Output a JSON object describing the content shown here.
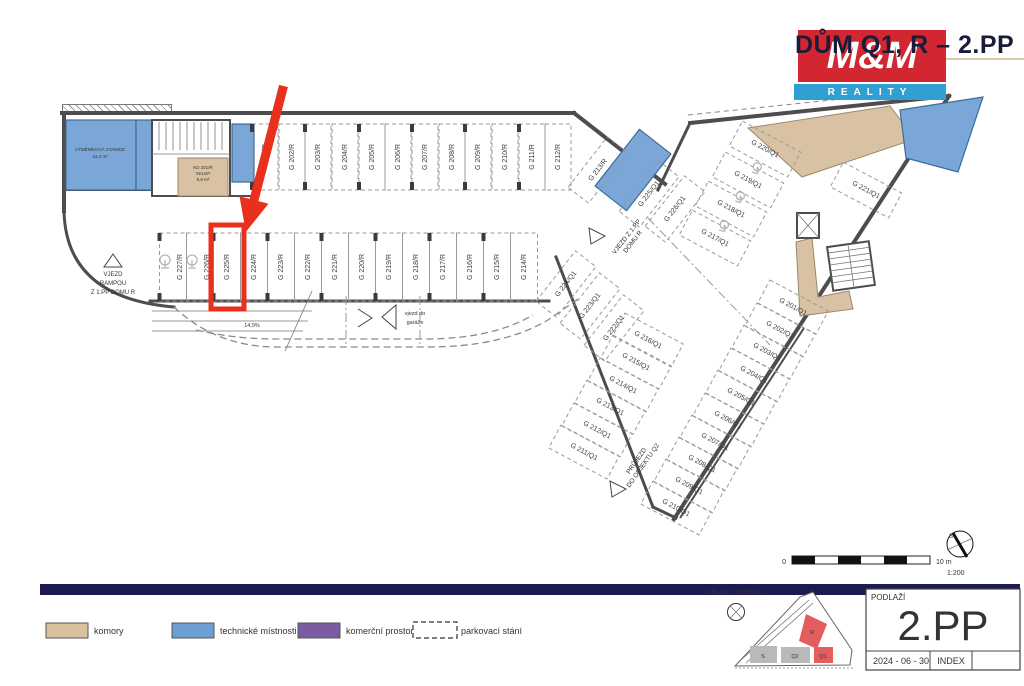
{
  "header": {
    "title": "DŮM Q1, R – 2.PP",
    "logo": {
      "top": "M&M",
      "bottom": "REALITY",
      "red": "#d22630",
      "blue": "#2f9fd4"
    }
  },
  "plan": {
    "texts": {
      "vjezd_rampou": [
        "VJEZD",
        "RAMPOU",
        "Z 1.PP DOMU R"
      ],
      "ramp_slope": "14,9%",
      "vjezd_garaz": [
        "vjezd do",
        "garáže"
      ],
      "vjezd_1pp": [
        "VJEZD Z 1.PP",
        "DOMU R"
      ],
      "prujezd": [
        "PRŮJEZD",
        "DO OBJEKTU Q2"
      ]
    },
    "rooms": {
      "vymenikova": [
        "VÝMĚNÍKOVÁ STANICE",
        "34,4 m²"
      ],
      "sklep": [
        "KD 201/R",
        "SKLEP",
        "5,9 m²"
      ]
    },
    "highlight": {
      "label": "G 225/R",
      "x": 211,
      "y": 225,
      "w": 33,
      "h": 84,
      "color": "#e8301c"
    },
    "stalls": [
      {
        "label": "G 201/R",
        "x": 265,
        "y": 157,
        "w": 26,
        "h": 66,
        "rot": 0,
        "lrot": -90
      },
      {
        "label": "G 202/R",
        "x": 292,
        "y": 157,
        "w": 26,
        "h": 66,
        "rot": 0,
        "lrot": -90
      },
      {
        "label": "G 203/R",
        "x": 318,
        "y": 157,
        "w": 26,
        "h": 66,
        "rot": 0,
        "lrot": -90
      },
      {
        "label": "G 204/R",
        "x": 345,
        "y": 157,
        "w": 26,
        "h": 66,
        "rot": 0,
        "lrot": -90
      },
      {
        "label": "G 205/R",
        "x": 372,
        "y": 157,
        "w": 26,
        "h": 66,
        "rot": 0,
        "lrot": -90
      },
      {
        "label": "G 206/R",
        "x": 398,
        "y": 157,
        "w": 26,
        "h": 66,
        "rot": 0,
        "lrot": -90
      },
      {
        "label": "G 207/R",
        "x": 425,
        "y": 157,
        "w": 26,
        "h": 66,
        "rot": 0,
        "lrot": -90
      },
      {
        "label": "G 208/R",
        "x": 452,
        "y": 157,
        "w": 26,
        "h": 66,
        "rot": 0,
        "lrot": -90
      },
      {
        "label": "G 209/R",
        "x": 478,
        "y": 157,
        "w": 26,
        "h": 66,
        "rot": 0,
        "lrot": -90
      },
      {
        "label": "G 210/R",
        "x": 505,
        "y": 157,
        "w": 26,
        "h": 66,
        "rot": 0,
        "lrot": -90
      },
      {
        "label": "G 211/R",
        "x": 532,
        "y": 157,
        "w": 26,
        "h": 66,
        "rot": 0,
        "lrot": -90
      },
      {
        "label": "G 212/R",
        "x": 558,
        "y": 157,
        "w": 26,
        "h": 66,
        "rot": 0,
        "lrot": -90
      },
      {
        "label": "G 227/R",
        "x": 173,
        "y": 267,
        "w": 27,
        "h": 68,
        "rot": 0,
        "lrot": -90,
        "icon": "moto"
      },
      {
        "label": "G 226/R",
        "x": 200,
        "y": 267,
        "w": 27,
        "h": 68,
        "rot": 0,
        "lrot": -90,
        "icon": "moto"
      },
      {
        "label": "G 225/R",
        "x": 227,
        "y": 267,
        "w": 27,
        "h": 68,
        "rot": 0,
        "lrot": -90
      },
      {
        "label": "G 224/R",
        "x": 254,
        "y": 267,
        "w": 27,
        "h": 68,
        "rot": 0,
        "lrot": -90
      },
      {
        "label": "G 223/R",
        "x": 281,
        "y": 267,
        "w": 27,
        "h": 68,
        "rot": 0,
        "lrot": -90
      },
      {
        "label": "G 222/R",
        "x": 308,
        "y": 267,
        "w": 27,
        "h": 68,
        "rot": 0,
        "lrot": -90
      },
      {
        "label": "G 221/R",
        "x": 335,
        "y": 267,
        "w": 27,
        "h": 68,
        "rot": 0,
        "lrot": -90
      },
      {
        "label": "G 220/R",
        "x": 362,
        "y": 267,
        "w": 27,
        "h": 68,
        "rot": 0,
        "lrot": -90
      },
      {
        "label": "G 219/R",
        "x": 389,
        "y": 267,
        "w": 27,
        "h": 68,
        "rot": 0,
        "lrot": -90
      },
      {
        "label": "G 218/R",
        "x": 416,
        "y": 267,
        "w": 27,
        "h": 68,
        "rot": 0,
        "lrot": -90
      },
      {
        "label": "G 217/R",
        "x": 443,
        "y": 267,
        "w": 27,
        "h": 68,
        "rot": 0,
        "lrot": -90
      },
      {
        "label": "G 216/R",
        "x": 470,
        "y": 267,
        "w": 27,
        "h": 68,
        "rot": 0,
        "lrot": -90
      },
      {
        "label": "G 215/R",
        "x": 497,
        "y": 267,
        "w": 27,
        "h": 68,
        "rot": 0,
        "lrot": -90
      },
      {
        "label": "G 214/R",
        "x": 524,
        "y": 267,
        "w": 27,
        "h": 68,
        "rot": 0,
        "lrot": -90
      },
      {
        "label": "G 213/R",
        "x": 598,
        "y": 170,
        "w": 64,
        "h": 26,
        "rot": -52,
        "lrot": -52
      },
      {
        "label": "G 225/Q1",
        "x": 649,
        "y": 194,
        "w": 64,
        "h": 26,
        "rot": -52,
        "lrot": -52
      },
      {
        "label": "G 226/Q1",
        "x": 675,
        "y": 209,
        "w": 64,
        "h": 26,
        "rot": -52,
        "lrot": -52
      },
      {
        "label": "G 224/Q1",
        "x": 566,
        "y": 284,
        "w": 64,
        "h": 26,
        "rot": -52,
        "lrot": -52
      },
      {
        "label": "G 223/Q1",
        "x": 590,
        "y": 306,
        "w": 64,
        "h": 26,
        "rot": -52,
        "lrot": -52
      },
      {
        "label": "G 222/Q1",
        "x": 614,
        "y": 328,
        "w": 64,
        "h": 26,
        "rot": -52,
        "lrot": -52
      },
      {
        "label": "G 217/Q1",
        "x": 715,
        "y": 238,
        "w": 66,
        "h": 28,
        "rot": 28,
        "lrot": 28,
        "icon": "wc"
      },
      {
        "label": "G 218/Q1",
        "x": 731,
        "y": 209,
        "w": 66,
        "h": 28,
        "rot": 28,
        "lrot": 28,
        "icon": "wc"
      },
      {
        "label": "G 219/Q1",
        "x": 748,
        "y": 180,
        "w": 66,
        "h": 28,
        "rot": 28,
        "lrot": 28,
        "icon": "wc"
      },
      {
        "label": "G 220/Q1",
        "x": 765,
        "y": 149,
        "w": 66,
        "h": 28,
        "rot": 28,
        "lrot": 28
      },
      {
        "label": "G 221/Q1",
        "x": 866,
        "y": 190,
        "w": 66,
        "h": 28,
        "rot": 28,
        "lrot": 28
      },
      {
        "label": "G 216/Q1",
        "x": 648,
        "y": 340,
        "w": 66,
        "h": 26,
        "rot": 28,
        "lrot": 28
      },
      {
        "label": "G 215/Q1",
        "x": 636,
        "y": 362,
        "w": 66,
        "h": 26,
        "rot": 28,
        "lrot": 28
      },
      {
        "label": "G 214/Q1",
        "x": 623,
        "y": 385,
        "w": 66,
        "h": 26,
        "rot": 28,
        "lrot": 28
      },
      {
        "label": "G 213/Q1",
        "x": 610,
        "y": 407,
        "w": 66,
        "h": 26,
        "rot": 28,
        "lrot": 28
      },
      {
        "label": "G 212/Q1",
        "x": 597,
        "y": 430,
        "w": 66,
        "h": 26,
        "rot": 28,
        "lrot": 28
      },
      {
        "label": "G 211/Q1",
        "x": 584,
        "y": 452,
        "w": 66,
        "h": 26,
        "rot": 28,
        "lrot": 28
      },
      {
        "label": "G 201/Q1",
        "x": 793,
        "y": 307,
        "w": 66,
        "h": 26,
        "rot": 28,
        "lrot": 28
      },
      {
        "label": "G 202/Q1",
        "x": 780,
        "y": 330,
        "w": 66,
        "h": 26,
        "rot": 28,
        "lrot": 28
      },
      {
        "label": "G 203/Q1",
        "x": 767,
        "y": 352,
        "w": 66,
        "h": 26,
        "rot": 28,
        "lrot": 28
      },
      {
        "label": "G 204/Q1",
        "x": 754,
        "y": 375,
        "w": 66,
        "h": 26,
        "rot": 28,
        "lrot": 28
      },
      {
        "label": "G 205/Q1",
        "x": 741,
        "y": 397,
        "w": 66,
        "h": 26,
        "rot": 28,
        "lrot": 28
      },
      {
        "label": "G 206/Q1",
        "x": 728,
        "y": 420,
        "w": 66,
        "h": 26,
        "rot": 28,
        "lrot": 28
      },
      {
        "label": "G 207/Q1",
        "x": 715,
        "y": 442,
        "w": 66,
        "h": 26,
        "rot": 28,
        "lrot": 28
      },
      {
        "label": "G 208/Q1",
        "x": 702,
        "y": 464,
        "w": 66,
        "h": 26,
        "rot": 28,
        "lrot": 28
      },
      {
        "label": "G 209/Q1",
        "x": 689,
        "y": 486,
        "w": 66,
        "h": 26,
        "rot": 28,
        "lrot": 28
      },
      {
        "label": "G 210/Q1",
        "x": 676,
        "y": 508,
        "w": 66,
        "h": 26,
        "rot": 28,
        "lrot": 28
      }
    ]
  },
  "scalebar": {
    "zero": "0",
    "max": "10 m",
    "ratio": "1:200",
    "north": "S"
  },
  "legend": {
    "items": [
      {
        "label": "komory",
        "color": "#d9c09e"
      },
      {
        "label": "technické místnosti",
        "color": "#6f9ed2"
      },
      {
        "label": "komerční prostory",
        "color": "#7b5ca3"
      },
      {
        "label": "parkovací stání",
        "color": "#ffffff"
      }
    ]
  },
  "situace": {
    "label": "situace - schéma",
    "buildings": {
      "s": "S",
      "q2": "Q2",
      "q1": "Q1",
      "r": "R"
    }
  },
  "titleblock": {
    "floor_label": "PODLAŽÍ",
    "floor": "2.PP",
    "date": "2024 - 06 - 30",
    "index": "INDEX"
  }
}
